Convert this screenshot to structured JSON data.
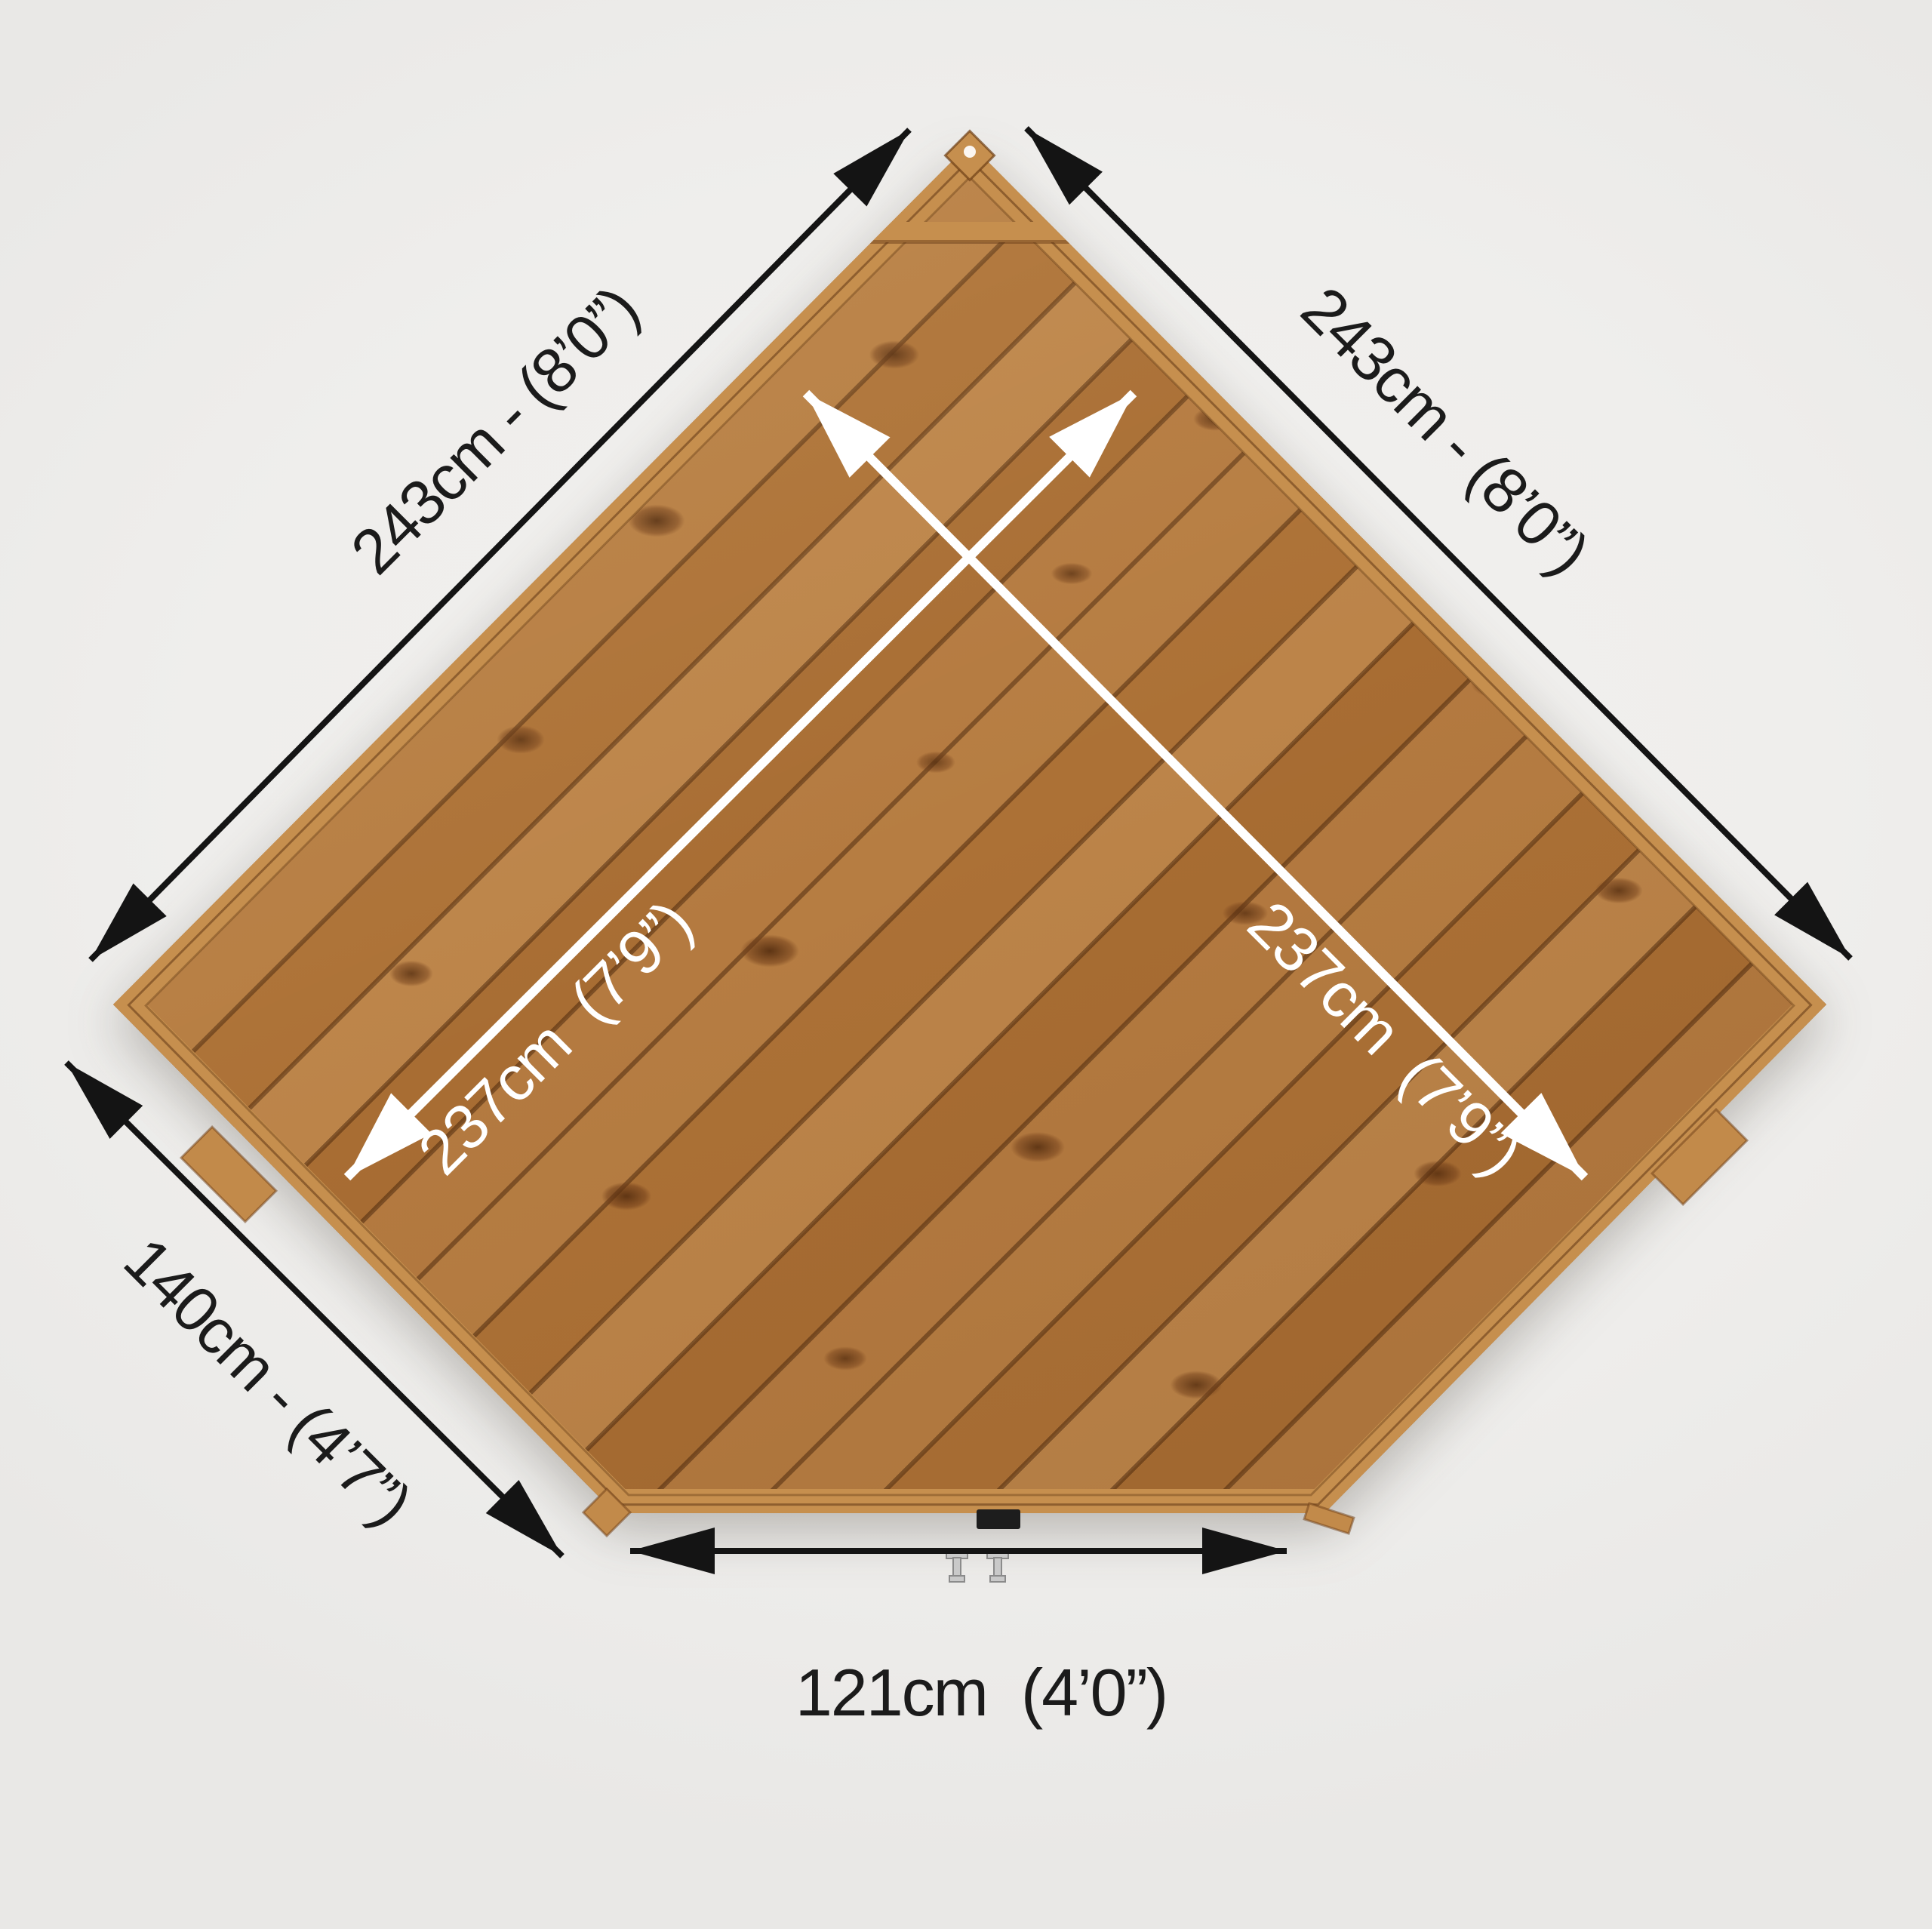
{
  "scene": {
    "title": "Corner shed wooden floor plan - top view dimension diagram",
    "background_color": "#efeeec",
    "wood_base_color": "#b1783e",
    "frame_color": "#c68f4e",
    "dimension_arrow_color": "#141414",
    "internal_arrow_color": "#ffffff"
  },
  "dimensions": {
    "back_left_wall": {
      "label": "243cm - (8’0”)"
    },
    "back_right_wall": {
      "label": "243cm - (8’0”)"
    },
    "diagonal_left": {
      "label": "237cm  (7’9”)"
    },
    "diagonal_right": {
      "label": "237cm  (7’9”)"
    },
    "side_left_wall": {
      "label": "140cm - (4’7”)"
    },
    "front_wall": {
      "label": "121cm  (4’0”)"
    }
  }
}
